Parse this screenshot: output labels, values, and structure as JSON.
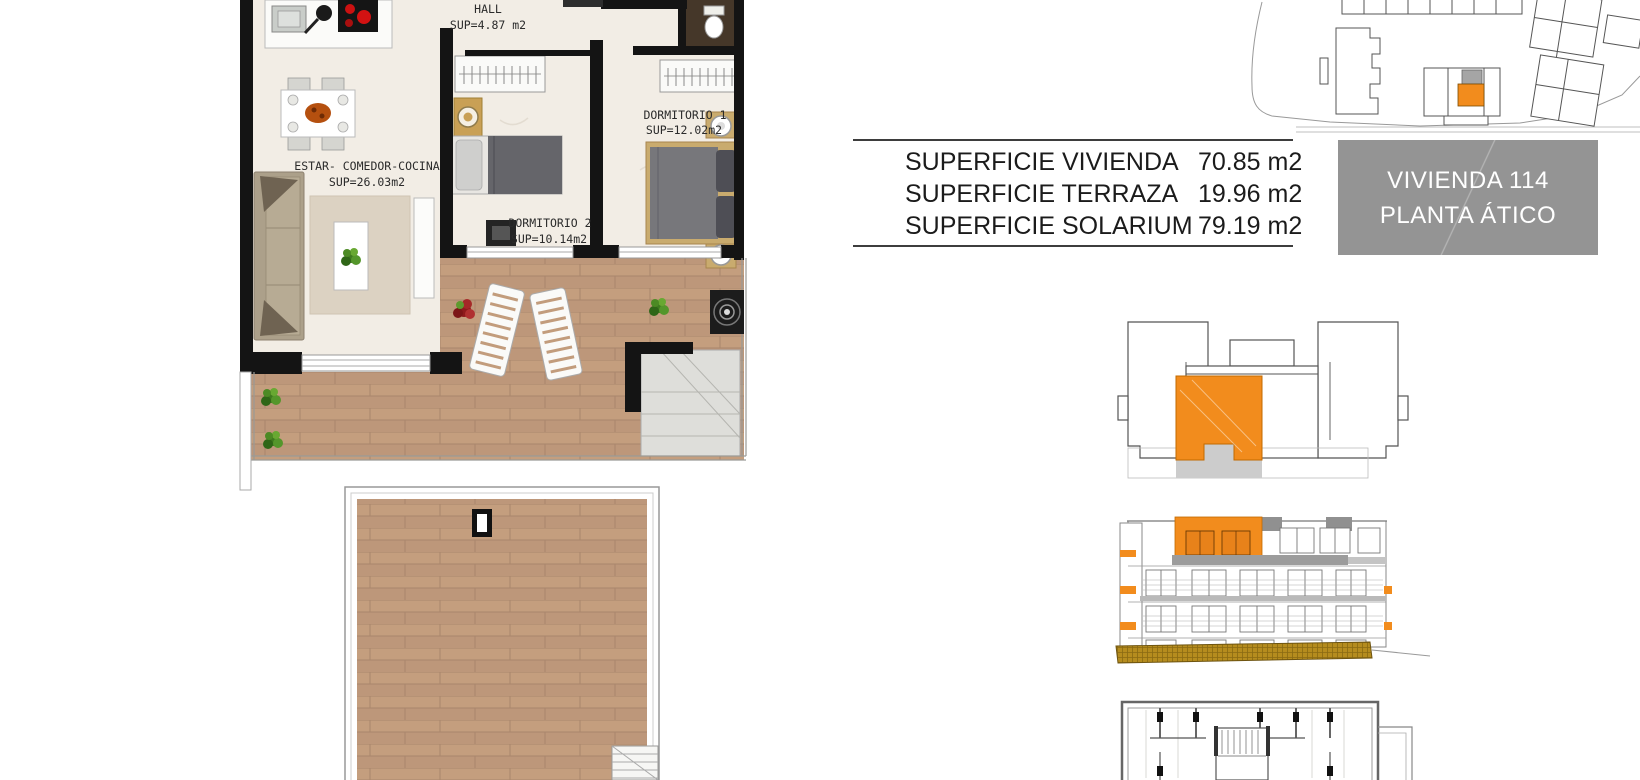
{
  "floor_plan": {
    "rooms": {
      "hall": {
        "name": "HALL",
        "area": "SUP=4.87 m2"
      },
      "living": {
        "name": "ESTAR- COMEDOR-COCINA",
        "area": "SUP=26.03m2"
      },
      "bedroom2": {
        "name": "DORMITORIO 2",
        "area": "SUP=10.14m2"
      },
      "bedroom1": {
        "name": "DORMITORIO 1",
        "area": "SUP=12.02m2"
      }
    }
  },
  "surface_table": {
    "rows": [
      {
        "label": "SUPERFICIE VIVIENDA",
        "value": "70.85 m2"
      },
      {
        "label": "SUPERFICIE TERRAZA",
        "value": "19.96 m2"
      },
      {
        "label": "SUPERFICIE SOLARIUM",
        "value": "79.19 m2"
      }
    ]
  },
  "unit_badge": {
    "line1": "VIVIENDA 114",
    "line2": "PLANTA ÁTICO"
  },
  "colors": {
    "accent_orange": "#F28C1D",
    "badge_gray": "#949494",
    "ground_ochre": "#B0871B",
    "wood_floor": "#C29C7C",
    "wall_black": "#141414"
  }
}
